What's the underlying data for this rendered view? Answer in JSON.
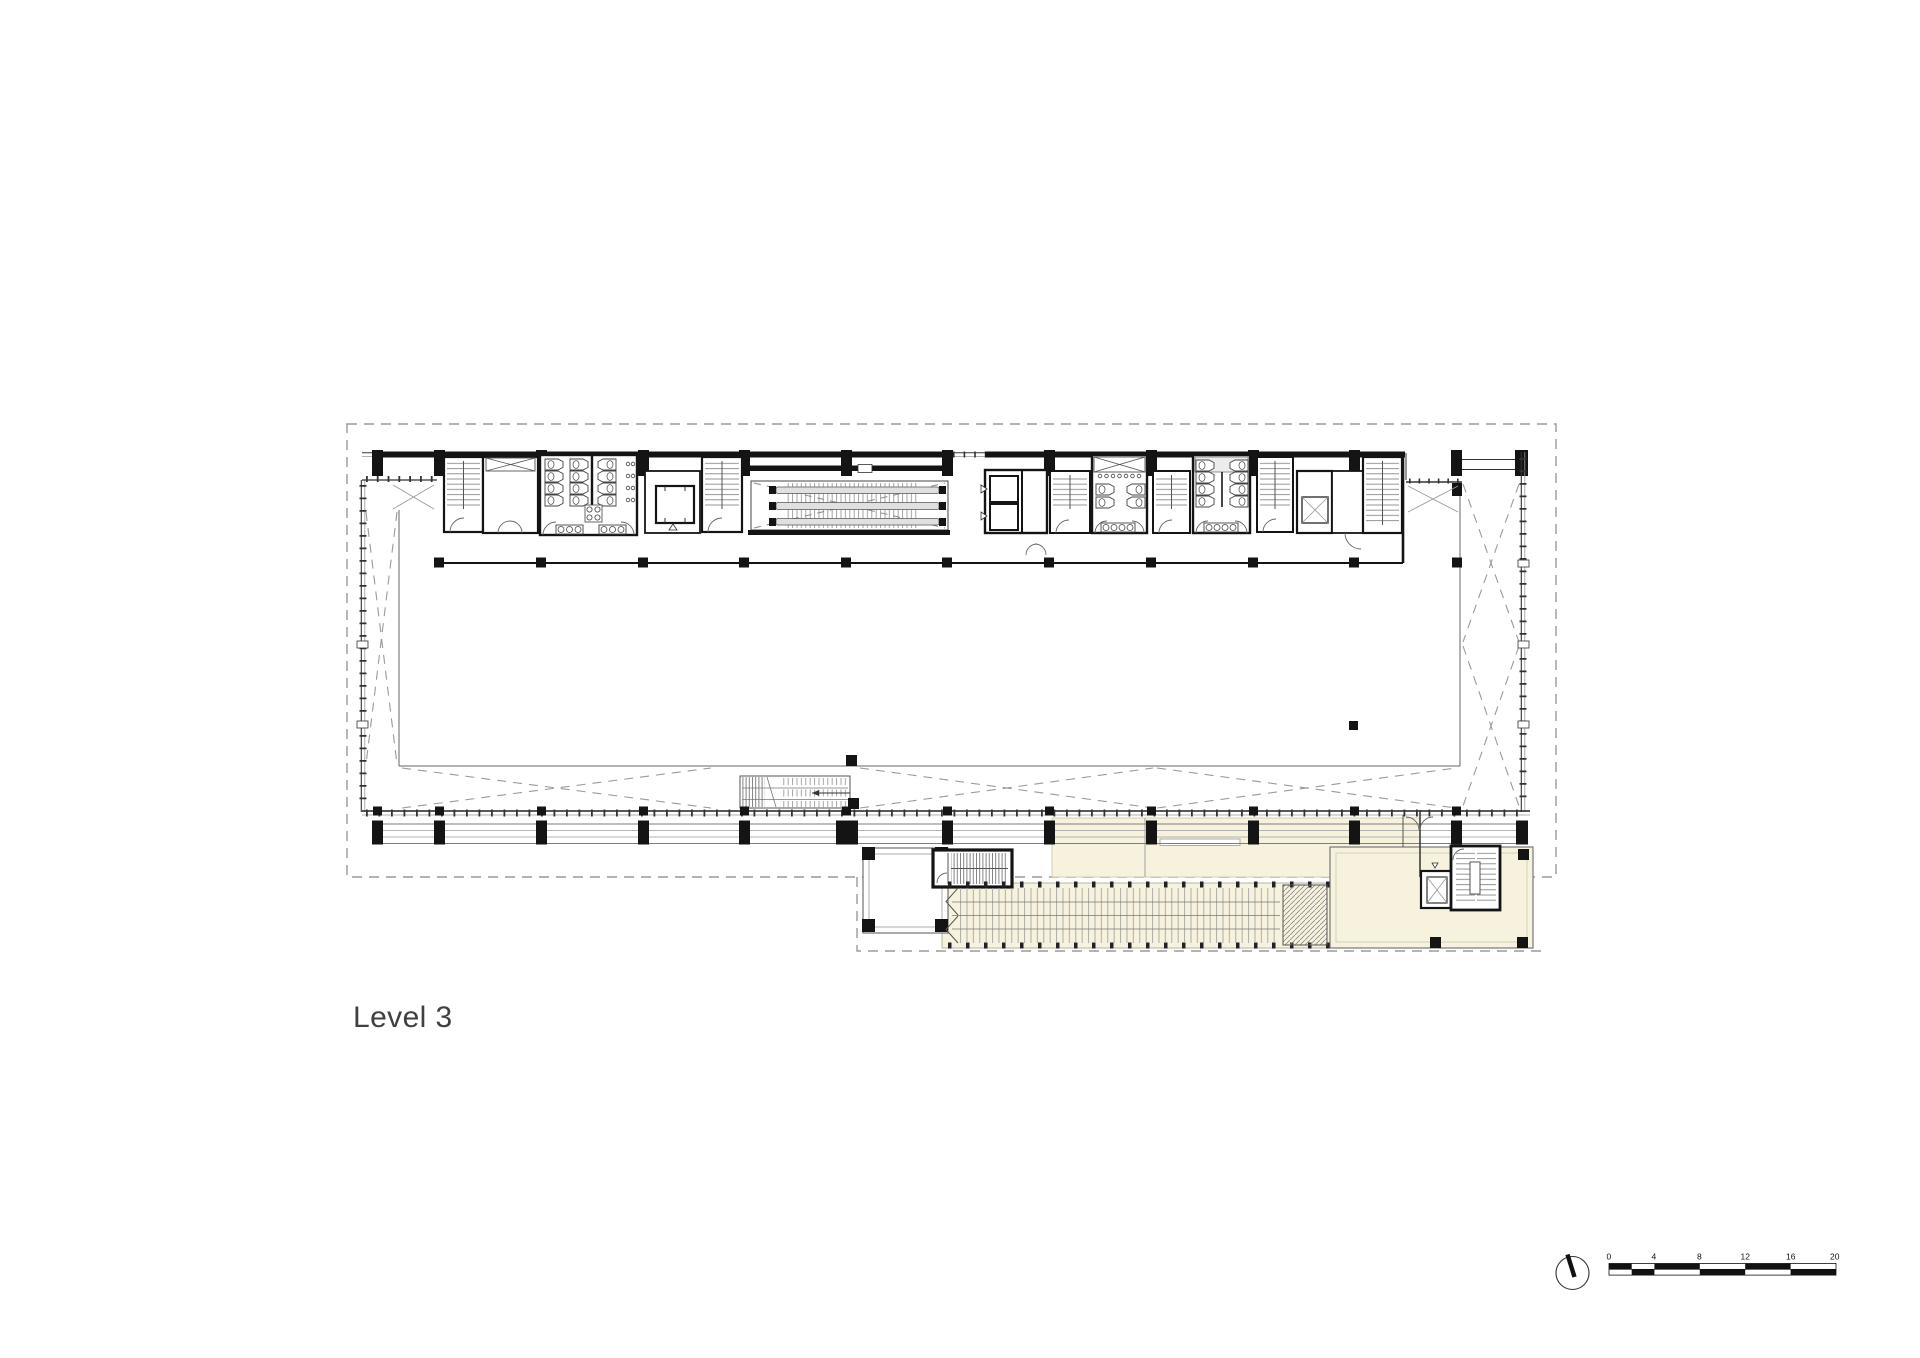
{
  "title": {
    "label": "Level 3"
  },
  "plan": {
    "name": "level-3-floor-plan",
    "colors": {
      "background": "#ffffff",
      "walls": "#141414",
      "thin_lines": "#8a8a8a",
      "dashed_boundary": "#9a9a9a",
      "annex_fill": "#f6f2dd",
      "handrail_fill": "#e0e0e0",
      "label_text": "#404040"
    },
    "components": [
      "upper-floor-dashed-outline",
      "annex-dashed-outline",
      "north-facade-wall",
      "south-curtain-wall",
      "west-curtain-wall",
      "east-curtain-wall",
      "colonnade",
      "atrium-void",
      "cross-bracing",
      "stair-1",
      "shaft-room",
      "toilet-room-west",
      "elevator-lobby",
      "stair-2",
      "escalator-pair",
      "elevator-bank",
      "stair-3",
      "toilet-room-center",
      "stair-4",
      "toilet-room-east",
      "stair-5",
      "elevator-east",
      "store-room",
      "stair-6",
      "east-terrace",
      "void-stair",
      "annex-grand-stair",
      "annex-stair-core",
      "annex-pavilion",
      "annex-elevator",
      "annex-stair-east",
      "annex-room"
    ]
  },
  "north_indicator": {
    "icon": "north-arrow-icon"
  },
  "scale_bar": {
    "unit_labels": [
      "0",
      "4",
      "8",
      "12",
      "16",
      "20"
    ]
  }
}
